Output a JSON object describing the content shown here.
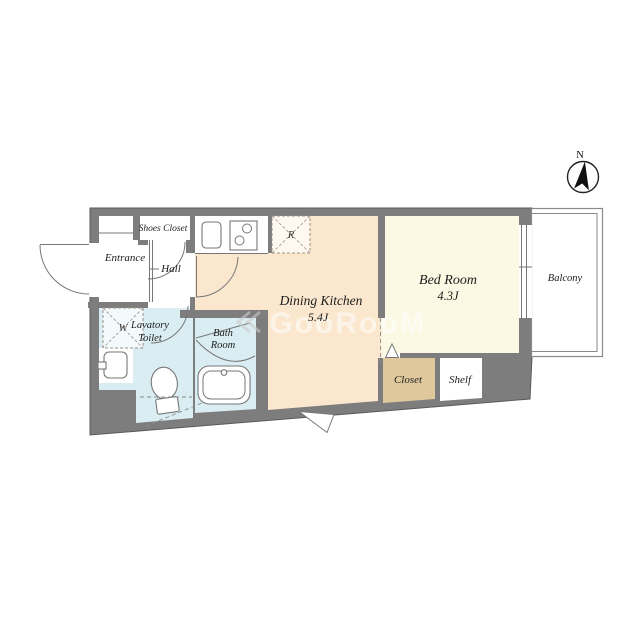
{
  "floorplan": {
    "rooms": {
      "entrance": {
        "label": "Entrance"
      },
      "hall": {
        "label": "Hall"
      },
      "shoes_closet": {
        "label": "Shoes Closet"
      },
      "lavatory_toilet": {
        "label_line1": "Lavatory",
        "label_line2": "Toilet"
      },
      "bath_room": {
        "label_line1": "Bath",
        "label_line2": "Room"
      },
      "dining_kitchen": {
        "label": "Dining Kitchen",
        "size": "5.4J"
      },
      "bed_room": {
        "label": "Bed Room",
        "size": "4.3J"
      },
      "closet": {
        "label": "Closet"
      },
      "shelf": {
        "label": "Shelf"
      },
      "balcony": {
        "label": "Balcony"
      }
    },
    "markers": {
      "refrigerator": "R",
      "washing_machine": "W"
    },
    "compass": {
      "north_label": "N"
    },
    "watermark": {
      "text": "GooRooM"
    },
    "colors": {
      "wall": "#7d7d7d",
      "dining_kitchen_floor": "#fae7ce",
      "bed_room_floor": "#fbf9e3",
      "wet_area_floor": "#d9edf2",
      "closet_floor": "#dfc89c",
      "balcony_outline": "#8a8a8a",
      "label_text": "#1c1c1c"
    }
  }
}
